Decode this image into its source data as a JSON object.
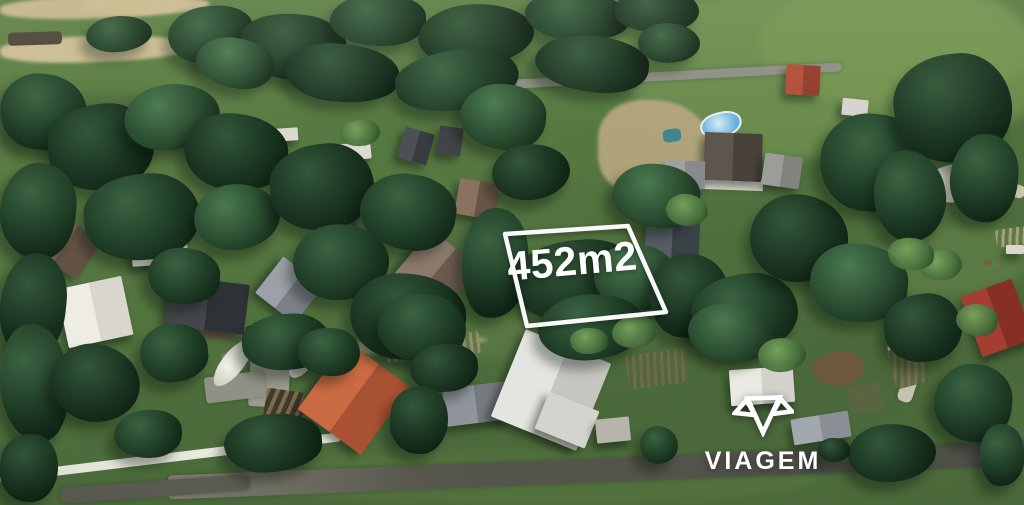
{
  "overlay": {
    "area_label": "452m2",
    "plot_points": "505,234 628,226 666,312 527,326",
    "outline_color": "#ffffff",
    "label_color": "#ffffff"
  },
  "watermark": {
    "brand": "VIAGEM",
    "icon": "viagem-gem-icon",
    "color": "#ffffff"
  },
  "palette": {
    "trees": [
      [
        "#4a7a50",
        "#2a4c30",
        "#152b1a"
      ],
      [
        "#3b6342",
        "#1f3d26",
        "#102416"
      ],
      [
        "#568a58",
        "#32583a",
        "#1a3320"
      ],
      [
        "#335739",
        "#1a3421",
        "#0d2012"
      ]
    ],
    "bush": [
      "#7aa45c",
      "#4b7340",
      "#2a4724"
    ]
  },
  "scene": {
    "fields": [
      [
        600,
        -10,
        440,
        168,
        0,
        "#6c8d4e",
        0.95
      ],
      [
        760,
        -15,
        270,
        120,
        0,
        "#74934f",
        0.9
      ],
      [
        300,
        58,
        340,
        130,
        -3,
        "#567941",
        0.9
      ],
      [
        880,
        225,
        150,
        70,
        -5,
        "#5d7d45",
        0.85
      ],
      [
        375,
        315,
        310,
        40,
        -4,
        "#5c7a45",
        0.75
      ],
      [
        240,
        450,
        580,
        55,
        0,
        "#54723e",
        0.85
      ],
      [
        0,
        95,
        180,
        70,
        -4,
        "#4c6b3a",
        0.9
      ],
      [
        60,
        375,
        250,
        95,
        0,
        "#4d6c3b",
        0.85
      ],
      [
        840,
        455,
        190,
        50,
        0,
        "#4e6d3c",
        0.9
      ]
    ],
    "dirt": [
      [
        0,
        -4,
        210,
        22,
        -2,
        "#c5b68c",
        1
      ],
      [
        84,
        -4,
        104,
        18,
        -1,
        "#cbbb8f",
        1
      ],
      [
        0,
        36,
        194,
        26,
        -2,
        "#ccbd93",
        1
      ],
      [
        598,
        100,
        115,
        98,
        0,
        "#b5a67f",
        0.95
      ],
      [
        222,
        342,
        266,
        13,
        -4,
        "#b2a888",
        0.8
      ],
      [
        578,
        326,
        66,
        18,
        -5,
        "#ab9e7f",
        0.85
      ],
      [
        427,
        75,
        95,
        14,
        8,
        "#8b8b81",
        1
      ]
    ],
    "roads": [
      [
        436,
        73,
        406,
        9,
        -3,
        "#8e8e84",
        5
      ],
      [
        884,
        246,
        13,
        58,
        10,
        "#cfc9b8",
        6
      ],
      [
        893,
        297,
        14,
        58,
        14,
        "#cbc5b4",
        6
      ],
      [
        904,
        349,
        15,
        54,
        18,
        "#c7c1b0",
        6
      ],
      [
        168,
        458,
        872,
        24,
        -2.3,
        "linear-gradient(90deg,#827f71,#55564c 30%,#4e5048)",
        4
      ],
      [
        60,
        481,
        190,
        16,
        -4.2,
        "#5b5c52",
        6
      ],
      [
        250,
        333,
        40,
        74,
        3,
        "#9a9a92",
        3
      ],
      [
        205,
        374,
        60,
        26,
        -7,
        "#8f9086",
        3
      ]
    ],
    "gardens": [
      [
        891,
        346,
        34,
        40,
        -15,
        "#7b6a4e",
        "#4d663c",
        105
      ],
      [
        996,
        228,
        30,
        18,
        -8,
        "#b3a27c",
        "#5d7a46",
        100
      ],
      [
        848,
        384,
        34,
        28,
        -12,
        "#6b5d45",
        "#50693e",
        100
      ],
      [
        627,
        352,
        58,
        34,
        -8,
        "#77684c",
        "#4f683d",
        95
      ],
      [
        386,
        336,
        94,
        22,
        -6,
        "#9a8d6b",
        "#5d7a46",
        90
      ]
    ],
    "misc": [
      [
        700,
        112,
        38,
        22,
        -12,
        "radial-gradient(circle at 45% 40%,#d6eef8,#66abd9 75%)",
        "border:2px solid #e9efee;border-radius:50% 45% 55% 50%",
        "swimming-pool"
      ],
      [
        663,
        129,
        18,
        13,
        -8,
        "#3f868d",
        "border-radius:30%",
        "tarp-pool"
      ],
      [
        871,
        121,
        16,
        10,
        12,
        "#2c333d",
        "border-radius:3px",
        "car"
      ],
      [
        8,
        32,
        54,
        13,
        -2,
        "#4a4438",
        "border-radius:4px",
        "wood-pile"
      ],
      [
        924,
        164,
        64,
        38,
        -8,
        "#d7d4c5",
        "border-radius:50%",
        "gravel-patch"
      ],
      [
        972,
        180,
        54,
        13,
        14,
        "#c9c5b3",
        "border-radius:6px",
        "gravel-path"
      ],
      [
        984,
        260,
        8,
        5,
        0,
        "#7a5c3a",
        "border-radius:50%",
        "animal"
      ],
      [
        995,
        264,
        6,
        4,
        0,
        "#8a6a44",
        "border-radius:50%",
        "animal"
      ],
      [
        264,
        390,
        38,
        44,
        8,
        "repeating-linear-gradient(105deg,#7d6b4d 0 4px,#41392c 4px 9px)",
        "border-radius:3px",
        "stairs"
      ],
      [
        -2,
        453,
        344,
        9,
        -6.9,
        "#e9e8dd",
        "border-radius:4px",
        "stone-wall"
      ],
      [
        701,
        178,
        62,
        12,
        2,
        "#e2e0d7",
        "",
        "house-wall"
      ],
      [
        205,
        352,
        56,
        22,
        -52,
        "radial-gradient(circle at 40% 40%,#f2f1e8,#cccfc2 60%,#9aa792 90%)",
        "border-radius:50%",
        "flowering-hedge"
      ],
      [
        282,
        349,
        44,
        20,
        -55,
        "radial-gradient(circle at 40% 40%,#f2f1e8,#cccfc2 60%,#9aa792 90%)",
        "border-radius:50%",
        "flowering-hedge"
      ],
      [
        812,
        352,
        52,
        34,
        -6,
        "#6d5a3e",
        "border-radius:50% 45% 50% 55%",
        "dry-bush"
      ],
      [
        193,
        321,
        40,
        17,
        6,
        "#6b5743",
        "border-radius:2px",
        "shed"
      ],
      [
        245,
        326,
        15,
        25,
        5,
        "#23272c",
        "border-radius:4px",
        "car"
      ]
    ],
    "houses": [
      [
        36,
        222,
        58,
        46,
        33,
        "#7d6d59",
        "#635344"
      ],
      [
        131,
        221,
        56,
        44,
        -4,
        "#e7e4da",
        "#cfccc1"
      ],
      [
        62,
        282,
        66,
        60,
        -12,
        "#eeece4",
        "#d9d7cd"
      ],
      [
        167,
        280,
        80,
        50,
        7,
        "#43474b",
        "#2e3236"
      ],
      [
        264,
        267,
        50,
        46,
        38,
        "#9ba1a6",
        "#7b8186"
      ],
      [
        328,
        204,
        30,
        22,
        12,
        "#6f5e4b",
        "#584939"
      ],
      [
        337,
        143,
        34,
        17,
        -6,
        "#dedacf",
        null
      ],
      [
        401,
        130,
        30,
        32,
        16,
        "#4c5054",
        "#393d41"
      ],
      [
        438,
        127,
        24,
        28,
        8,
        "#414549",
        null
      ],
      [
        457,
        181,
        40,
        36,
        10,
        "#8a7263",
        "#6b5546"
      ],
      [
        406,
        242,
        62,
        58,
        40,
        "#8a7a6a",
        "#6c5b4d"
      ],
      [
        645,
        220,
        54,
        46,
        3,
        "#565d63",
        "#3a4147"
      ],
      [
        704,
        133,
        58,
        48,
        2,
        "#5e564c",
        "#48423a"
      ],
      [
        665,
        161,
        40,
        28,
        1,
        "#9da1a3",
        "#878b8d"
      ],
      [
        763,
        155,
        38,
        32,
        8,
        "#9c9c98",
        "#83837e"
      ],
      [
        786,
        65,
        34,
        30,
        3,
        "#b34d39",
        "#923b2b"
      ],
      [
        970,
        286,
        54,
        64,
        -20,
        "#a33e30",
        "#862f24"
      ],
      [
        315,
        356,
        78,
        84,
        36,
        "#c96a42",
        "#a85233"
      ],
      [
        444,
        385,
        64,
        38,
        -7,
        "#90959b",
        "#757a80"
      ],
      [
        505,
        343,
        92,
        94,
        22,
        "#e4e4e0",
        "#c6c6c0"
      ],
      [
        540,
        400,
        54,
        40,
        22,
        "#d4d4ce",
        null
      ],
      [
        596,
        418,
        34,
        24,
        -6,
        "#b6b4ab",
        null
      ],
      [
        730,
        368,
        64,
        36,
        -4,
        "#eae9e3",
        "#d3d2ca"
      ],
      [
        792,
        415,
        58,
        26,
        -9,
        "#a3a8af",
        "#8a8f96"
      ],
      [
        275,
        128,
        23,
        13,
        -4,
        "#dcd8cb",
        null
      ],
      [
        842,
        99,
        26,
        17,
        6,
        "#d7d3ce",
        null
      ],
      [
        1006,
        245,
        18,
        9,
        0,
        "#dcd8cf",
        null
      ]
    ],
    "trees": [
      [
        168,
        6,
        86,
        56,
        -8,
        1
      ],
      [
        240,
        14,
        108,
        66,
        6,
        3
      ],
      [
        330,
        -6,
        96,
        52,
        0,
        1
      ],
      [
        418,
        4,
        116,
        62,
        -5,
        3
      ],
      [
        525,
        -8,
        104,
        48,
        4,
        1
      ],
      [
        615,
        -10,
        84,
        42,
        0,
        3
      ],
      [
        196,
        38,
        78,
        50,
        10,
        0
      ],
      [
        86,
        16,
        66,
        36,
        -6,
        1
      ],
      [
        285,
        44,
        114,
        58,
        5,
        3
      ],
      [
        395,
        50,
        124,
        60,
        -8,
        1
      ],
      [
        535,
        36,
        114,
        56,
        6,
        3
      ],
      [
        638,
        23,
        62,
        40,
        0,
        1
      ],
      [
        0,
        74,
        86,
        76,
        8,
        1
      ],
      [
        48,
        104,
        106,
        86,
        -6,
        3
      ],
      [
        0,
        163,
        76,
        96,
        5,
        1
      ],
      [
        124,
        84,
        96,
        66,
        -10,
        0
      ],
      [
        184,
        114,
        104,
        76,
        7,
        3
      ],
      [
        84,
        174,
        116,
        86,
        -5,
        1
      ],
      [
        0,
        253,
        66,
        106,
        6,
        3
      ],
      [
        194,
        184,
        86,
        66,
        -8,
        0
      ],
      [
        148,
        248,
        72,
        56,
        4,
        1
      ],
      [
        270,
        144,
        104,
        86,
        -6,
        3
      ],
      [
        360,
        174,
        96,
        76,
        8,
        1
      ],
      [
        293,
        224,
        96,
        76,
        -5,
        1
      ],
      [
        350,
        274,
        116,
        86,
        6,
        3
      ],
      [
        242,
        314,
        88,
        56,
        -4,
        1
      ],
      [
        460,
        84,
        86,
        66,
        5,
        0
      ],
      [
        492,
        144,
        78,
        56,
        -7,
        3
      ],
      [
        462,
        208,
        66,
        110,
        4,
        1
      ],
      [
        514,
        240,
        128,
        82,
        -4,
        3
      ],
      [
        594,
        244,
        82,
        66,
        6,
        0
      ],
      [
        538,
        294,
        108,
        66,
        -6,
        1
      ],
      [
        650,
        254,
        78,
        84,
        5,
        3
      ],
      [
        692,
        274,
        106,
        78,
        -7,
        1
      ],
      [
        612,
        164,
        88,
        64,
        6,
        0
      ],
      [
        750,
        194,
        98,
        88,
        -5,
        3
      ],
      [
        820,
        114,
        108,
        98,
        7,
        1
      ],
      [
        894,
        54,
        118,
        108,
        -6,
        3
      ],
      [
        950,
        134,
        68,
        88,
        5,
        1
      ],
      [
        874,
        150,
        72,
        92,
        -4,
        1
      ],
      [
        810,
        244,
        98,
        78,
        6,
        0
      ],
      [
        884,
        294,
        78,
        68,
        -6,
        3
      ],
      [
        934,
        364,
        78,
        78,
        5,
        1
      ],
      [
        848,
        424,
        88,
        58,
        -5,
        3
      ],
      [
        980,
        424,
        44,
        62,
        0,
        1
      ],
      [
        378,
        294,
        88,
        68,
        6,
        1
      ],
      [
        410,
        344,
        68,
        48,
        -5,
        3
      ],
      [
        640,
        426,
        38,
        38,
        0,
        1
      ],
      [
        818,
        438,
        32,
        24,
        0,
        3
      ],
      [
        390,
        386,
        58,
        68,
        5,
        3
      ],
      [
        0,
        324,
        68,
        118,
        -5,
        1
      ],
      [
        52,
        344,
        88,
        78,
        6,
        3
      ],
      [
        140,
        324,
        68,
        58,
        -6,
        1
      ],
      [
        0,
        434,
        58,
        68,
        5,
        3
      ],
      [
        114,
        410,
        68,
        48,
        -4,
        1
      ],
      [
        688,
        304,
        88,
        58,
        6,
        0
      ],
      [
        224,
        414,
        98,
        58,
        -5,
        3
      ],
      [
        298,
        328,
        62,
        48,
        4,
        1
      ]
    ],
    "bushes": [
      [
        612,
        316,
        44,
        32,
        -6
      ],
      [
        666,
        194,
        42,
        32,
        5
      ],
      [
        570,
        328,
        38,
        26,
        0
      ],
      [
        920,
        250,
        42,
        30,
        -5
      ],
      [
        956,
        304,
        42,
        32,
        6
      ],
      [
        758,
        338,
        48,
        34,
        -4
      ],
      [
        888,
        238,
        46,
        32,
        5
      ],
      [
        340,
        120,
        40,
        26,
        -5
      ]
    ]
  }
}
